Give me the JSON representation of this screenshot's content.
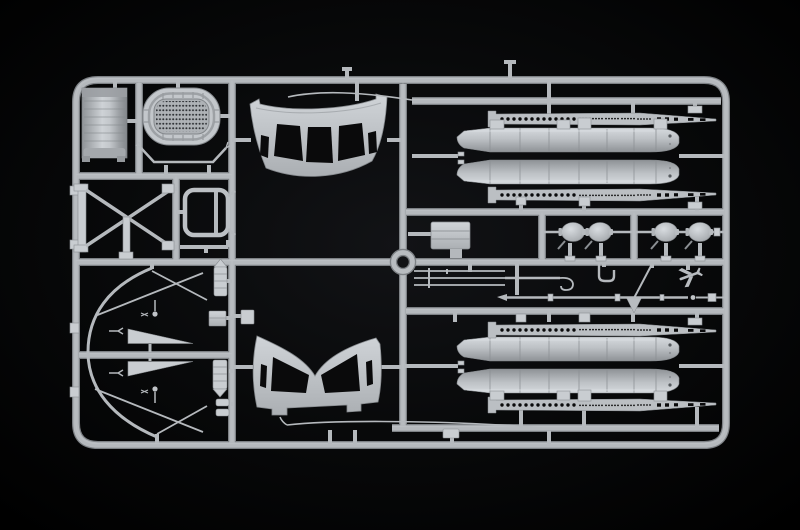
{
  "scene": {
    "media": "photograph",
    "subject": "Light grey injection-moulded model kit parts sprue (parts tree) photographed on a black background",
    "orientation": "landscape",
    "text_visible": "none"
  },
  "colors": {
    "background": "#000000",
    "vignette": "#101113",
    "plastic": "#b5b9bd",
    "plastic_light": "#c9cdd1",
    "plastic_dark": "#8b8f93",
    "plastic_shadow": "#7d8185",
    "mesh": "#aeb2b6",
    "hole": "#0a0a0b"
  },
  "parts": [
    {
      "id": "sprue-frame",
      "label": "rectangular outer sprue frame with internal runners"
    },
    {
      "id": "locator-ring",
      "label": "central round locator ring"
    },
    {
      "id": "canvas-tarp",
      "label": "folded canvas / tarpaulin rectangular panel"
    },
    {
      "id": "mesh-grille",
      "label": "oval panel with perforated mesh grille"
    },
    {
      "id": "support-yoke",
      "label": "V-shaped support yoke rod with forked ends"
    },
    {
      "id": "cross-brace",
      "label": "X cross-braced rigging frame"
    },
    {
      "id": "loop-frame",
      "label": "small rounded rectangular open frame"
    },
    {
      "id": "seat-bar",
      "label": "flat bar with hooked ends"
    },
    {
      "id": "arched-panel-upper",
      "label": "curved bulkhead panel with three cut-outs and two slots"
    },
    {
      "id": "gullwing-panel-lower",
      "label": "curved bulkhead panel with deep central V notch"
    },
    {
      "id": "float-pair-upper",
      "label": "pair of long cylindrical pontoon/float halves with pointed noses"
    },
    {
      "id": "float-pair-lower",
      "label": "second pair of long cylindrical pontoon/float halves"
    },
    {
      "id": "walkway-strips",
      "label": "four tapered perforated walkway strips with rows of holes"
    },
    {
      "id": "float-tips",
      "label": "four bulb-shaped float tips strung on a rod"
    },
    {
      "id": "stowage-box",
      "label": "ribbed rectangular stowage box"
    },
    {
      "id": "rod-set",
      "label": "set of three parallel rods merging into a hooked rod"
    },
    {
      "id": "u-bracket",
      "label": "small U-shaped bracket"
    },
    {
      "id": "mast-diagonal",
      "label": "diagonal strut with triangular gusset"
    },
    {
      "id": "long-rod",
      "label": "long tapered mast / boat-hook rod with collars"
    },
    {
      "id": "collared-shaft",
      "label": "short shaft with bead and collar"
    },
    {
      "id": "mini-aircraft",
      "label": "miniature aircraft silhouette part"
    },
    {
      "id": "bow-hoop",
      "label": "large thin curved hoop"
    },
    {
      "id": "fins",
      "label": "two flat triangular fins"
    },
    {
      "id": "rigging-rods",
      "label": "thin rigging rods with ball and clevis ends"
    },
    {
      "id": "canisters",
      "label": "ribbed canisters and small boxes"
    },
    {
      "id": "whip-upper",
      "label": "thin curved whip antenna rod (top)"
    },
    {
      "id": "whip-lower",
      "label": "thin curved batten rod (bottom)"
    }
  ]
}
